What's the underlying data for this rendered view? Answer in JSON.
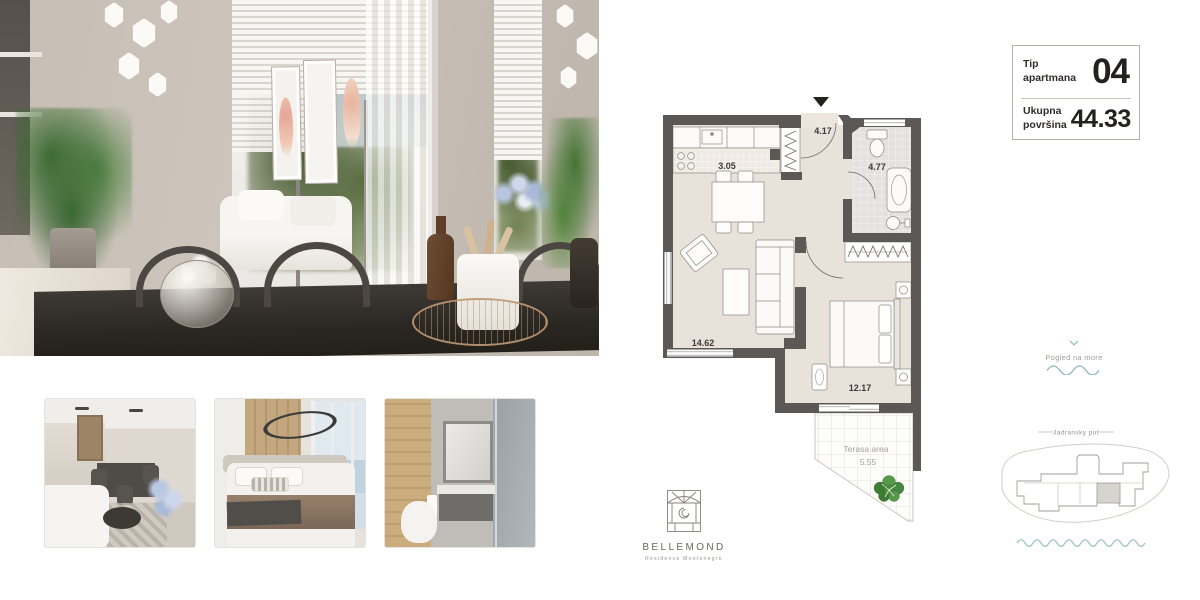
{
  "info_box": {
    "type_label": "Tip apartmana",
    "type_value": "04",
    "area_label": "Ukupna površina",
    "area_value": "44.33"
  },
  "floorplan": {
    "hall_area": "4.17",
    "kitchen_area": "3.05",
    "bathroom_area": "4.77",
    "living_area": "14.62",
    "bedroom_area": "12.17",
    "terrace_label": "Terasa area",
    "terrace_area": "5.55"
  },
  "view_widget": {
    "label": "Pogled na more"
  },
  "site_plan": {
    "road_label": "Jadransky put"
  },
  "brand": {
    "name": "BELLEMOND",
    "tagline": "Residence Montenegro"
  },
  "colors": {
    "accent_teal": "#9cc0c9",
    "wall": "#5b5855",
    "floor": "#e9e2db",
    "tree_green": "#4c8c3c"
  }
}
